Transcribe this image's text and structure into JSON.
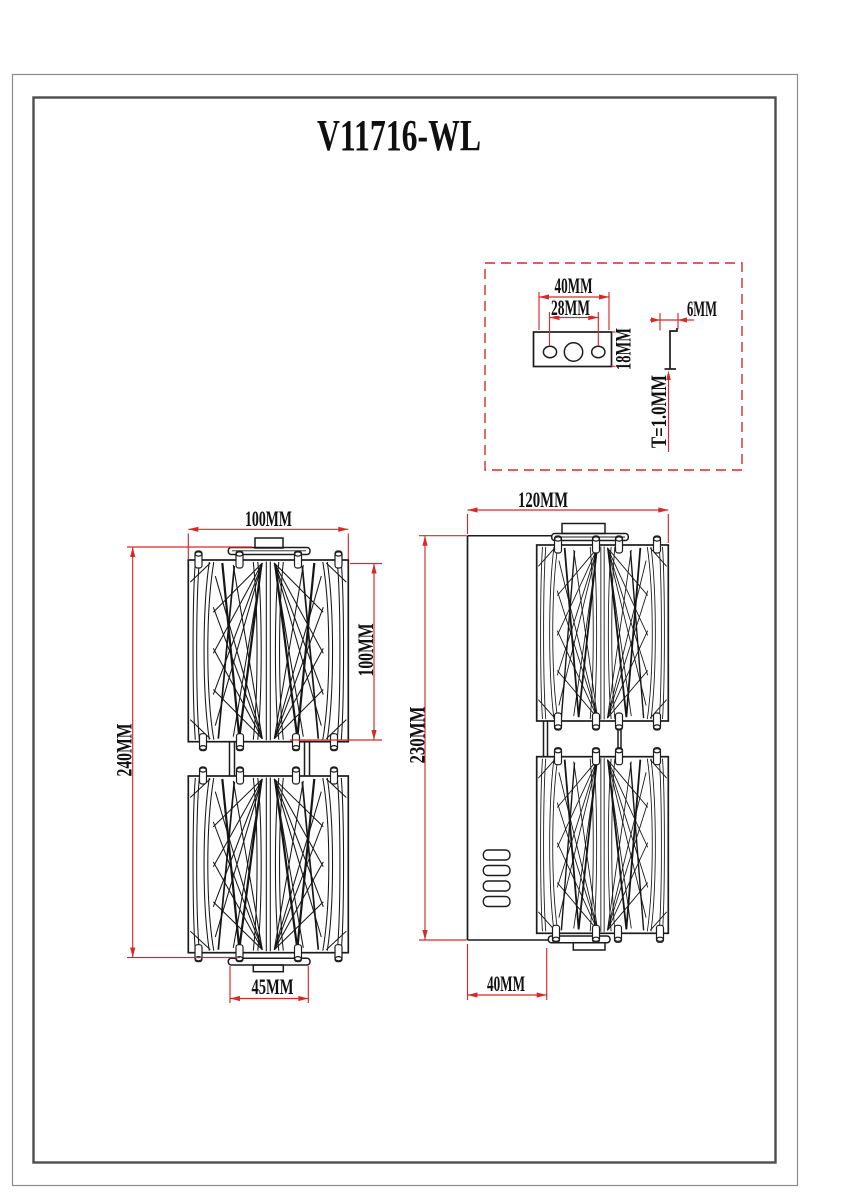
{
  "title": "V11716-WL",
  "colors": {
    "dimension_red": "#d42a2a",
    "drawing_black": "#1c1c1c",
    "frame_outer": "#8c8c8c",
    "frame_inner": "#4d4d4d"
  },
  "detail_inset": {
    "label": "mounting-bracket-detail",
    "dims": {
      "bracket_width": "40MM",
      "hole_spacing": "28MM",
      "bracket_height": "18MM",
      "flange_width": "6MM",
      "thickness": "T=1.0MM"
    }
  },
  "front_view": {
    "label": "front-view",
    "dims": {
      "shade_width": "100MM",
      "overall_height": "240MM",
      "module_height": "100MM",
      "canopy_width": "45MM"
    }
  },
  "side_view": {
    "label": "side-view",
    "dims": {
      "overall_width": "120MM",
      "body_height": "230MM",
      "backplate_depth": "40MM"
    }
  }
}
